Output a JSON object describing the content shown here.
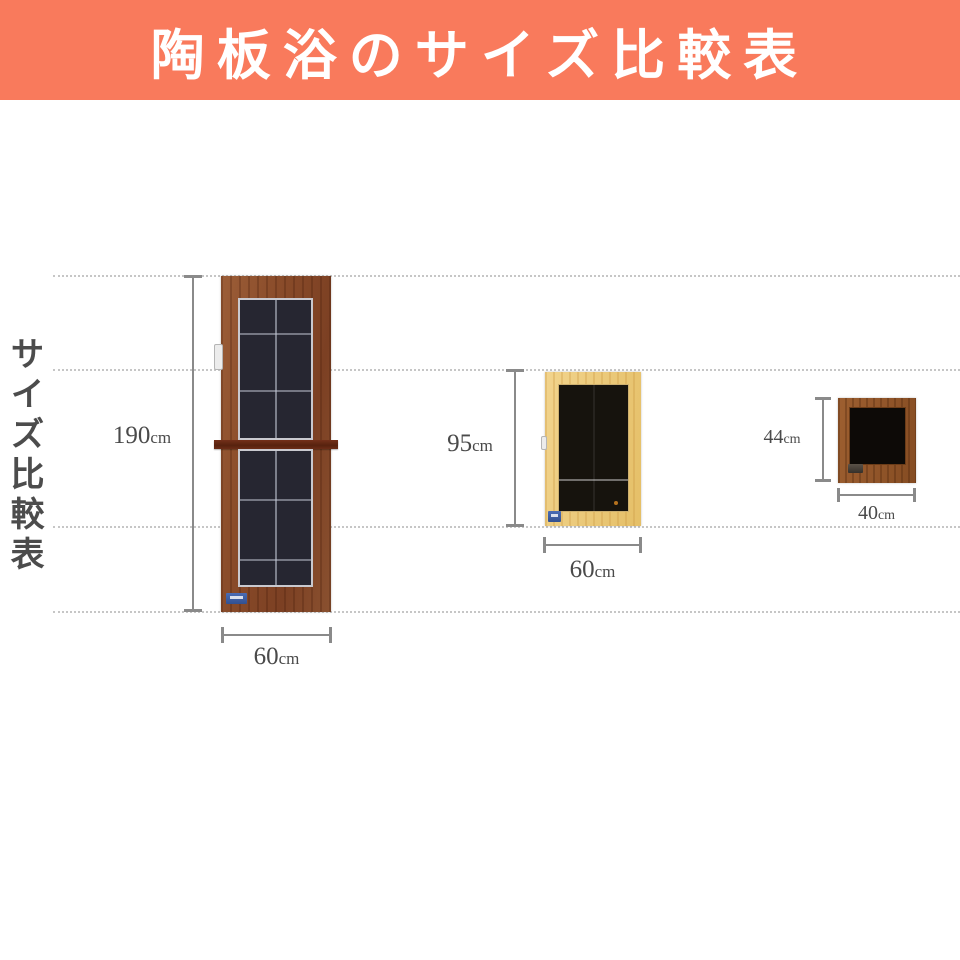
{
  "banner": {
    "title": "陶板浴のサイズ比較表",
    "bg_color": "#f97a5c",
    "text_color": "#ffffff"
  },
  "side_label": {
    "text": "サイズ比較表"
  },
  "guide_line_color": "#c6c6c6",
  "measure_color": "#8a8a8a",
  "panels": [
    {
      "id": "large",
      "height_value": "190",
      "height_unit": "cm",
      "width_value": "60",
      "width_unit": "cm",
      "wood_color": "#8a4c2a",
      "glass_color": "#262631",
      "badge_color": "#3d5fa8"
    },
    {
      "id": "medium",
      "height_value": "95",
      "height_unit": "cm",
      "width_value": "60",
      "width_unit": "cm",
      "wood_color": "#eac878",
      "glass_color": "#16130d",
      "badge_color": "#4a6cb5"
    },
    {
      "id": "small",
      "height_value": "44",
      "height_unit": "cm",
      "width_value": "40",
      "width_unit": "cm",
      "wood_color": "#92562a",
      "glass_color": "#0d0a07",
      "badge_color": "#4a4038"
    }
  ]
}
